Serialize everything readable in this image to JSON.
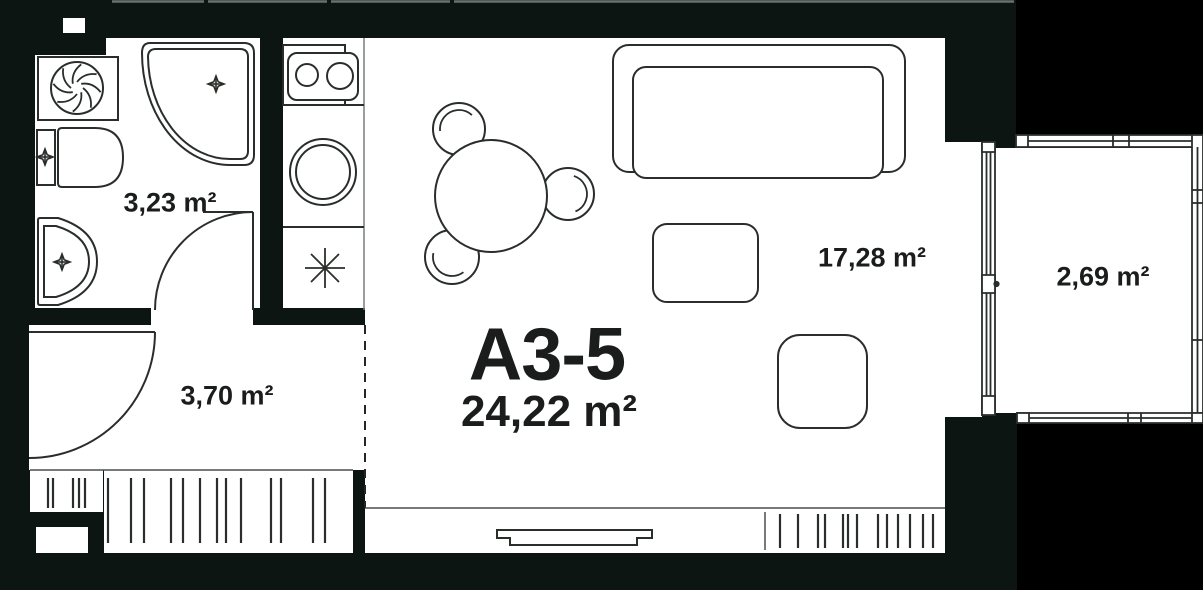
{
  "plan": {
    "unit": {
      "label": "A3-5",
      "area_label": "24,22 m²"
    },
    "rooms": [
      {
        "id": "bathroom",
        "area_label": "3,23 m²"
      },
      {
        "id": "hallway",
        "area_label": "3,70 m²"
      },
      {
        "id": "living-kitchen",
        "area_label": "17,28 m²"
      },
      {
        "id": "balcony",
        "area_label": "2,69 m²"
      }
    ],
    "icons": [
      "fan-icon",
      "drain-cross-icon",
      "stove-burners-icon",
      "kitchen-sink-icon",
      "electric-star-icon"
    ],
    "colors": {
      "page_background": "#000000",
      "building_mass": "#0c1511",
      "room_fill": "#ffffff",
      "line": "#2a2e2b",
      "text": "#1a1d1b"
    }
  }
}
